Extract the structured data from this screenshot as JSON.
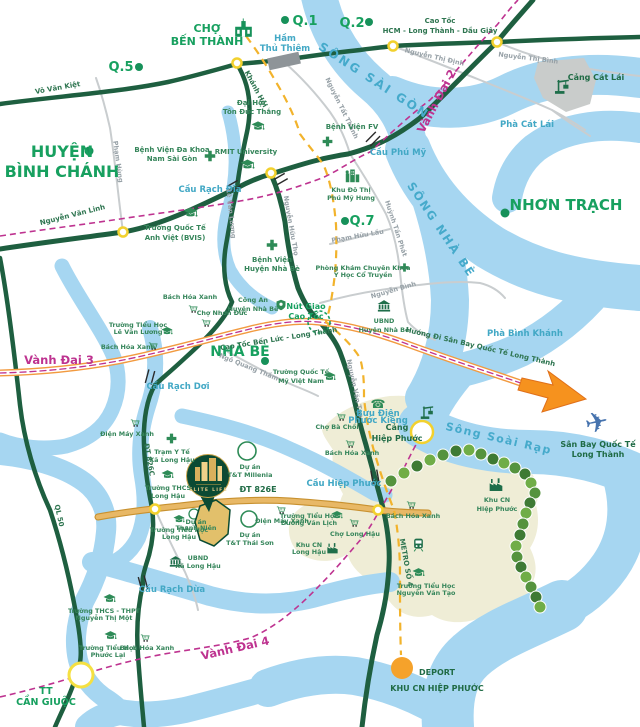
{
  "title": "ELITE LIFE location map",
  "colors": {
    "water": "#A6D6F1",
    "road_green": "#1E5F40",
    "road_gray": "#C9CDCF",
    "road_tan": "#E8B866",
    "ring_road_magenta": "#BE3390",
    "metro_yellow": "#F2B32C",
    "region_green": "#17A05F",
    "landmark_green": "#35855A",
    "bridge_teal": "#42A8C5",
    "beige_zone": "#EFEDD6",
    "arrow_orange": "#F6921E",
    "deport_orange": "#F5A22B",
    "node_yellow": "#F2D12E",
    "pin_dark_green": "#0B4A33",
    "pin_gold": "#D9B05C"
  },
  "t": {
    "cho_ben_thanh": [
      "CHỢ",
      "BẾN THÀNH"
    ],
    "q1": "Q.1",
    "q2": "Q.2",
    "q5": "Q.5",
    "q7": "Q.7",
    "ham_thu_thiem": [
      "Hầm",
      "Thủ Thiêm"
    ],
    "cao_toc_hlg": [
      "Cao Tốc",
      "HCM - Long Thành - Dầu Giây"
    ],
    "nguyen_thi_binh": "Nguyễn Thị Bình",
    "cang_cat_lai": "Cảng Cát Lái",
    "pha_cat_lai": "Phà Cát Lái",
    "vanh_dai_2": "Vành Đai 2",
    "song_sai_gon": "SÔNG SÀI GÒN",
    "vo_van_kiet": "Võ Văn Kiệt",
    "khanh_hoi": "Khánh Hội",
    "nguyen_tat_thanh": "Nguyễn Tất Thành",
    "nguyen_thi_dinh": "Nguyễn Thị Định",
    "dh_ton_duc_thang": [
      "Đại Học",
      "Tôn Đức Thắng"
    ],
    "rmit": "RMIT University",
    "bv_nam_sai_gon": [
      "Bệnh Viện Đa Khoa",
      "Nam Sài Gòn"
    ],
    "bv_fv": "Bệnh Viện FV",
    "cau_phu_my": "Cầu Phú Mỹ",
    "khu_do_thi_pmh": [
      "Khu Đô Thị",
      "Phú Mỹ Hưng"
    ],
    "huyen_binh_chanh": [
      "HUYỆN",
      "BÌNH CHÁNH"
    ],
    "pham_hung": "Phạm Hùng",
    "nguyen_van_linh": "Nguyễn Văn Linh",
    "cau_rach_dia": "Cầu Rạch Đĩa",
    "pham_huu_lau": "Phạm Hữu Lầu",
    "huynh_tan_phat": "Huỳnh Tấn Phát",
    "song_nha_be": "SÔNG NHÀ BÈ",
    "nhon_trach": "NHƠN TRẠCH",
    "bvis": [
      "Trường Quốc Tế",
      "Anh Việt (BVIS)"
    ],
    "le_van_luong": "Lê Văn Lương",
    "nguyen_huu_tho": "Nguyễn Hữu Thọ",
    "bv_nha_be": [
      "Bệnh Viện",
      "Huyện Nhà Bè"
    ],
    "phong_kham": [
      "Phòng Khám Chuyên Khoa",
      "Y Học Cổ Truyền"
    ],
    "nguyen_binh": "Nguyễn Bình",
    "cong_an": [
      "Công An",
      "Huyện Nhà Bè"
    ],
    "nut_giao": [
      "Nút Giao",
      "Cao Tốc"
    ],
    "ubnd_nha_be": [
      "UBND",
      "Huyện Nhà Bè"
    ],
    "pha_binh_khanh": "Phà Bình Khánh",
    "bach_hoa_xanh": "Bách Hóa Xanh",
    "cho_nhon_duc": "Chợ Nhơn Đức",
    "th_le_van_luong": [
      "Trường Tiểu Học",
      "Lê Văn Lương"
    ],
    "nha_be": "NHÀ BÈ",
    "ngo_quang_tham": "Ngô Quang Thắm",
    "cao_toc_ben_luc": "Cao Tốc Bến Lức - Long Thành",
    "vanh_dai_3": "Vành Đai 3",
    "mvn": [
      "Trường Quốc Tế",
      "Mỹ Việt Nam"
    ],
    "cau_rach_doi": "Cầu Rạch Dơi",
    "nguyen_van_tao": "Nguyễn Văn Tạo",
    "huong_di": "Hướng Đi Sân Bay Quốc Tế Long Thành",
    "san_bay": [
      "Sân Bay Quốc Tế",
      "Long Thành"
    ],
    "buu_dien": [
      "Bưu Điện",
      "Phước Kiểng"
    ],
    "cho_ba_choi": "Chợ Bà Chồi",
    "song_soai_rap": "Sông Soài Rạp",
    "cang_hiep_phuoc": [
      "Cảng",
      "Hiệp Phước"
    ],
    "cau_hiep_phuoc": "Cầu Hiệp Phước",
    "dt_826e": "ĐT 826E",
    "tt_millenia": [
      "Dự án",
      "T&T Millenia"
    ],
    "tt_thai_son": [
      "Dự án",
      "T&T Thái Sơn"
    ],
    "du_an_thanh_nien": [
      "Dự án",
      "Thanh Niên"
    ],
    "dien_may_xanh": "Điện Máy Xanh",
    "tram_y_te": [
      "Trạm Y Tế",
      "Xã Long Hậu"
    ],
    "thcs_long_hau": [
      "Trường THCS",
      "Long Hậu"
    ],
    "elite_life": "ELITE LIFE",
    "ubnd_long_hau": [
      "UBND",
      "Xã Long Hậu"
    ],
    "th_long_hau": [
      "Trường Tiểu Học",
      "Long Hậu"
    ],
    "th_duong_van_lich": [
      "Trường Tiểu Học",
      "Dương Văn Lịch"
    ],
    "cho_long_hau": "Chợ Long Hậu",
    "kcn_long_hau": [
      "Khu CN",
      "Long Hậu"
    ],
    "kcn_hiep_phuoc": [
      "Khu CN",
      "Hiệp Phước"
    ],
    "metro_so_4": "METRO SỐ 4",
    "th_nguyen_van_tao": [
      "Trường Tiểu Học",
      "Nguyễn Văn Tạo"
    ],
    "cau_rach_dua": "Cầu Rạch Dừa",
    "thcs_thpt_ntm": [
      "Trường THCS - THPT",
      "Nguyễn Thị Một"
    ],
    "th_phuoc_lai": [
      "Trường Tiểu Học",
      "Phước Lại"
    ],
    "vanh_dai_4": "Vành Đai 4",
    "tt_can_giuoc": [
      "TT",
      "CẦN GIUỘC"
    ],
    "ql50": "QL 50",
    "dt_826c": "ĐT 826C",
    "deport": [
      "DEPORT",
      "KHU CN HIỆP PHƯỚC"
    ]
  }
}
